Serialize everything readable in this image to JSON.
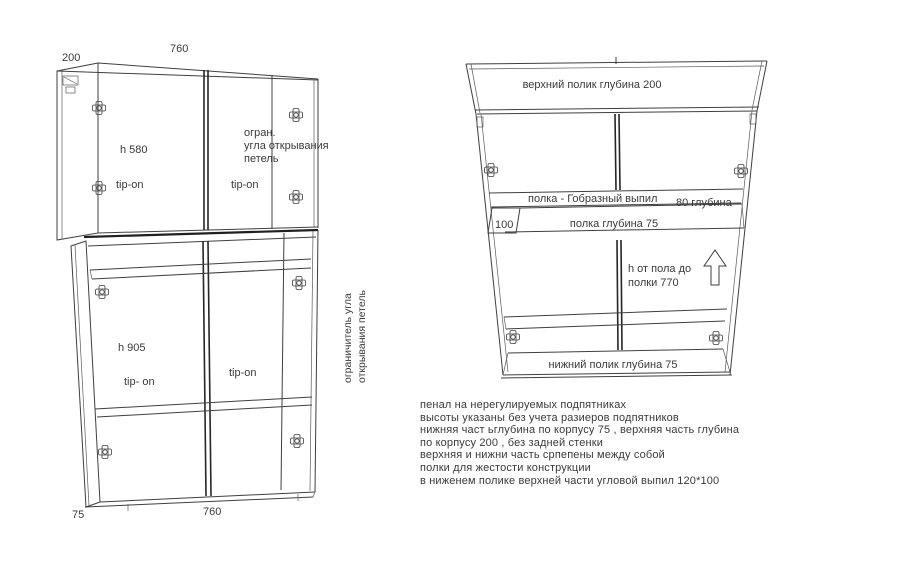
{
  "front": {
    "dim_top_width": "760",
    "dim_top_depth": "200",
    "dim_bottom_depth": "75",
    "dim_bottom_width": "760",
    "upper_height": "h 580",
    "upper_left_door": "tip-on",
    "upper_right_door": "tip-on",
    "hinge_note1": "огран.",
    "hinge_note2": "угла открывания",
    "hinge_note3": "петель",
    "lower_height": "h 905",
    "lower_left_door": "tip- on",
    "lower_right_door": "tip-on",
    "side_note1": "ограничитель угла",
    "side_note2": "открывания петель"
  },
  "perspective": {
    "top_shelf": "верхний  полик  глубина 200",
    "shelf_cut": "полка  - Гобразный выпил",
    "shelf_cut_depth": "80 глубина",
    "cut_size": "100",
    "middle_shelf": "полка  глубина 75",
    "height_note1": "h от пола до",
    "height_note2": "полки 770",
    "bottom_shelf": "нижний полик глубина 75"
  },
  "notes": [
    "пенал на нерегулируемых подпятниках",
    "высоты указаны без учета разиеров подпятников",
    "нижняя част ьглубина по корпусу 75 , верхняя часть глубина",
    "по корпусу 200 , без задней стенки",
    "верхняя и нижни часть српепены между собой",
    "полки для жестости конструкции",
    "в ниженем полике верхней части угловой выпил  120*100"
  ],
  "colors": {
    "line": "#3f3f3f",
    "heavy_line": "#1f1f1f",
    "text": "#3a3a3a",
    "background": "#ffffff"
  }
}
